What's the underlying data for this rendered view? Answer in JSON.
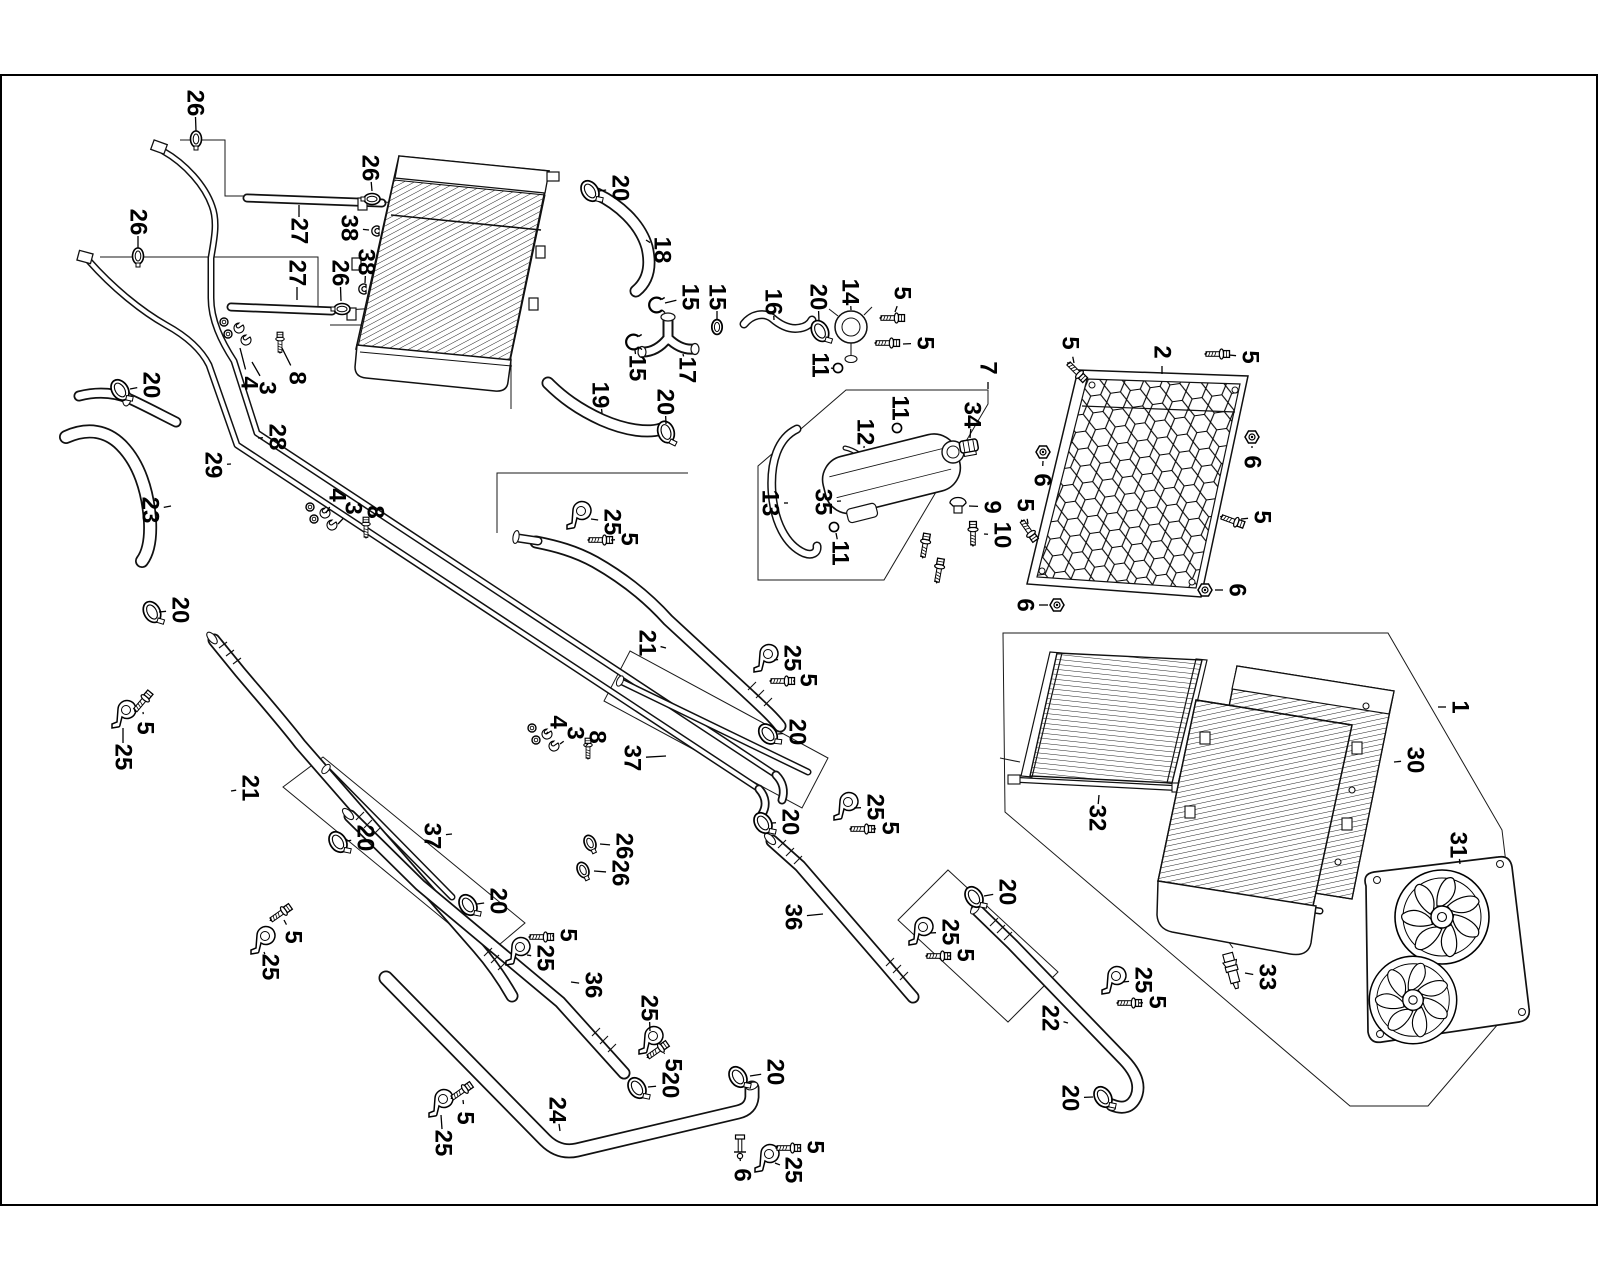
{
  "diagram": {
    "description": "Exploded line-art parts diagram of an engine cooling system (radiators, mesh grille, expansion tank, fan shroud, hoses, pipes and clamps) with numbered callouts",
    "colors": {
      "line": "#111111",
      "background": "#ffffff"
    },
    "part_numbers_shown": [
      1,
      2,
      3,
      4,
      5,
      6,
      7,
      8,
      9,
      10,
      11,
      12,
      13,
      14,
      15,
      16,
      17,
      18,
      19,
      20,
      21,
      22,
      23,
      24,
      25,
      26,
      27,
      28,
      29,
      30,
      31,
      32,
      33,
      34,
      35,
      36,
      37,
      38
    ],
    "callouts": [
      {
        "n": "26",
        "x": 195,
        "y": 103,
        "lx": 196,
        "ly": 131
      },
      {
        "n": "26",
        "x": 370,
        "y": 168,
        "lx": 372,
        "ly": 191
      },
      {
        "n": "27",
        "x": 299,
        "y": 231,
        "lx": 299,
        "ly": 205
      },
      {
        "n": "38",
        "x": 349,
        "y": 228,
        "lx": 369,
        "ly": 230
      },
      {
        "n": "26",
        "x": 138,
        "y": 222,
        "lx": 138,
        "ly": 248
      },
      {
        "n": "38",
        "x": 366,
        "y": 262,
        "lx": 365,
        "ly": 283
      },
      {
        "n": "27",
        "x": 297,
        "y": 273,
        "lx": 297,
        "ly": 300
      },
      {
        "n": "26",
        "x": 340,
        "y": 273,
        "lx": 341,
        "ly": 301
      },
      {
        "n": "20",
        "x": 151,
        "y": 385,
        "lx": 130,
        "ly": 389
      },
      {
        "n": "4",
        "x": 249,
        "y": 383,
        "lx": 240,
        "ly": 348
      },
      {
        "n": "3",
        "x": 267,
        "y": 388,
        "lx": 252,
        "ly": 362
      },
      {
        "n": "8",
        "x": 297,
        "y": 378,
        "lx": 282,
        "ly": 348
      },
      {
        "n": "28",
        "x": 277,
        "y": 437,
        "lx": 258,
        "ly": 438
      },
      {
        "n": "29",
        "x": 213,
        "y": 465,
        "lx": 231,
        "ly": 464
      },
      {
        "n": "23",
        "x": 150,
        "y": 510,
        "lx": 171,
        "ly": 506
      },
      {
        "n": "4",
        "x": 337,
        "y": 495,
        "lx": 326,
        "ly": 513
      },
      {
        "n": "3",
        "x": 353,
        "y": 508,
        "lx": 338,
        "ly": 524
      },
      {
        "n": "8",
        "x": 375,
        "y": 512,
        "lx": 366,
        "ly": 522
      },
      {
        "n": "20",
        "x": 180,
        "y": 610,
        "lx": 159,
        "ly": 612
      },
      {
        "n": "5",
        "x": 145,
        "y": 728,
        "lx": 143,
        "ly": 712
      },
      {
        "n": "25",
        "x": 123,
        "y": 757,
        "lx": 123,
        "ly": 728
      },
      {
        "n": "21",
        "x": 250,
        "y": 788,
        "lx": 231,
        "ly": 791
      },
      {
        "n": "5",
        "x": 293,
        "y": 937,
        "lx": 284,
        "ly": 920
      },
      {
        "n": "25",
        "x": 270,
        "y": 967,
        "lx": 264,
        "ly": 952
      },
      {
        "n": "20",
        "x": 365,
        "y": 838,
        "lx": 347,
        "ly": 841
      },
      {
        "n": "37",
        "x": 432,
        "y": 836,
        "lx": 452,
        "ly": 834
      },
      {
        "n": "20",
        "x": 498,
        "y": 901,
        "lx": 477,
        "ly": 904
      },
      {
        "n": "20",
        "x": 620,
        "y": 188,
        "lx": 599,
        "ly": 191
      },
      {
        "n": "18",
        "x": 662,
        "y": 250,
        "lx": 646,
        "ly": 240
      },
      {
        "n": "15",
        "x": 690,
        "y": 297,
        "lx": 665,
        "ly": 303
      },
      {
        "n": "15",
        "x": 717,
        "y": 297,
        "lx": 717,
        "ly": 319
      },
      {
        "n": "16",
        "x": 773,
        "y": 302,
        "lx": 774,
        "ly": 320
      },
      {
        "n": "20",
        "x": 818,
        "y": 297,
        "lx": 819,
        "ly": 321
      },
      {
        "n": "14",
        "x": 850,
        "y": 292,
        "lx": 851,
        "ly": 310
      },
      {
        "n": "5",
        "x": 902,
        "y": 293,
        "lx": 895,
        "ly": 312
      },
      {
        "n": "5",
        "x": 925,
        "y": 343,
        "lx": 903,
        "ly": 344
      },
      {
        "n": "11",
        "x": 820,
        "y": 365,
        "lx": 831,
        "ly": 368
      },
      {
        "n": "15",
        "x": 637,
        "y": 368,
        "lx": 635,
        "ly": 350
      },
      {
        "n": "17",
        "x": 687,
        "y": 370,
        "lx": 683,
        "ly": 354
      },
      {
        "n": "19",
        "x": 600,
        "y": 395,
        "lx": 602,
        "ly": 413
      },
      {
        "n": "20",
        "x": 665,
        "y": 402,
        "lx": 666,
        "ly": 424
      },
      {
        "n": "7",
        "x": 988,
        "y": 368,
        "lx": 988,
        "ly": 389
      },
      {
        "n": "34",
        "x": 972,
        "y": 415,
        "lx": 970,
        "ly": 438
      },
      {
        "n": "12",
        "x": 865,
        "y": 432,
        "lx": 864,
        "ly": 448
      },
      {
        "n": "11",
        "x": 900,
        "y": 408,
        "lx": 898,
        "ly": 422
      },
      {
        "n": "13",
        "x": 770,
        "y": 503,
        "lx": 788,
        "ly": 503
      },
      {
        "n": "35",
        "x": 823,
        "y": 502,
        "lx": 841,
        "ly": 501
      },
      {
        "n": "11",
        "x": 840,
        "y": 553,
        "lx": 836,
        "ly": 533
      },
      {
        "n": "9",
        "x": 992,
        "y": 507,
        "lx": 969,
        "ly": 506
      },
      {
        "n": "10",
        "x": 1002,
        "y": 535,
        "lx": 984,
        "ly": 534
      },
      {
        "n": "2",
        "x": 1162,
        "y": 352,
        "lx": 1162,
        "ly": 374
      },
      {
        "n": "5",
        "x": 1070,
        "y": 343,
        "lx": 1074,
        "ly": 363
      },
      {
        "n": "5",
        "x": 1250,
        "y": 357,
        "lx": 1229,
        "ly": 355
      },
      {
        "n": "6",
        "x": 1042,
        "y": 480,
        "lx": 1043,
        "ly": 461
      },
      {
        "n": "5",
        "x": 1025,
        "y": 505,
        "lx": 1028,
        "ly": 524
      },
      {
        "n": "6",
        "x": 1252,
        "y": 462,
        "lx": 1252,
        "ly": 446
      },
      {
        "n": "5",
        "x": 1262,
        "y": 517,
        "lx": 1241,
        "ly": 519
      },
      {
        "n": "6",
        "x": 1237,
        "y": 590,
        "lx": 1215,
        "ly": 590
      },
      {
        "n": "6",
        "x": 1025,
        "y": 605,
        "lx": 1048,
        "ly": 605
      },
      {
        "n": "1",
        "x": 1460,
        "y": 707,
        "lx": 1438,
        "ly": 707
      },
      {
        "n": "30",
        "x": 1415,
        "y": 760,
        "lx": 1394,
        "ly": 762
      },
      {
        "n": "32",
        "x": 1097,
        "y": 818,
        "lx": 1099,
        "ly": 795
      },
      {
        "n": "31",
        "x": 1458,
        "y": 845,
        "lx": 1460,
        "ly": 864
      },
      {
        "n": "33",
        "x": 1267,
        "y": 977,
        "lx": 1245,
        "ly": 973
      },
      {
        "n": "25",
        "x": 612,
        "y": 522,
        "lx": 591,
        "ly": 519
      },
      {
        "n": "5",
        "x": 629,
        "y": 539,
        "lx": 611,
        "ly": 540
      },
      {
        "n": "21",
        "x": 647,
        "y": 643,
        "lx": 666,
        "ly": 648
      },
      {
        "n": "25",
        "x": 792,
        "y": 658,
        "lx": 774,
        "ly": 660
      },
      {
        "n": "5",
        "x": 808,
        "y": 680,
        "lx": 793,
        "ly": 681
      },
      {
        "n": "20",
        "x": 797,
        "y": 732,
        "lx": 778,
        "ly": 734
      },
      {
        "n": "37",
        "x": 632,
        "y": 758,
        "lx": 666,
        "ly": 756
      },
      {
        "n": "26",
        "x": 624,
        "y": 846,
        "lx": 600,
        "ly": 844
      },
      {
        "n": "26",
        "x": 620,
        "y": 873,
        "lx": 594,
        "ly": 871
      },
      {
        "n": "4",
        "x": 558,
        "y": 722,
        "lx": 546,
        "ly": 734
      },
      {
        "n": "3",
        "x": 575,
        "y": 733,
        "lx": 560,
        "ly": 744
      },
      {
        "n": "8",
        "x": 597,
        "y": 737,
        "lx": 588,
        "ly": 744
      },
      {
        "n": "36",
        "x": 593,
        "y": 985,
        "lx": 571,
        "ly": 982
      },
      {
        "n": "5",
        "x": 568,
        "y": 935,
        "lx": 552,
        "ly": 936
      },
      {
        "n": "25",
        "x": 545,
        "y": 958,
        "lx": 527,
        "ly": 955
      },
      {
        "n": "25",
        "x": 649,
        "y": 1008,
        "lx": 650,
        "ly": 1031
      },
      {
        "n": "5",
        "x": 673,
        "y": 1065,
        "lx": 664,
        "ly": 1053
      },
      {
        "n": "20",
        "x": 670,
        "y": 1085,
        "lx": 648,
        "ly": 1087
      },
      {
        "n": "24",
        "x": 557,
        "y": 1110,
        "lx": 560,
        "ly": 1131
      },
      {
        "n": "25",
        "x": 443,
        "y": 1143,
        "lx": 441,
        "ly": 1115
      },
      {
        "n": "5",
        "x": 465,
        "y": 1118,
        "lx": 463,
        "ly": 1100
      },
      {
        "n": "20",
        "x": 775,
        "y": 1072,
        "lx": 750,
        "ly": 1076
      },
      {
        "n": "5",
        "x": 815,
        "y": 1147,
        "lx": 798,
        "ly": 1148
      },
      {
        "n": "25",
        "x": 793,
        "y": 1170,
        "lx": 775,
        "ly": 1163
      },
      {
        "n": "6",
        "x": 742,
        "y": 1175,
        "lx": 740,
        "ly": 1158
      },
      {
        "n": "36",
        "x": 793,
        "y": 917,
        "lx": 823,
        "ly": 914
      },
      {
        "n": "25",
        "x": 875,
        "y": 807,
        "lx": 854,
        "ly": 808
      },
      {
        "n": "5",
        "x": 890,
        "y": 828,
        "lx": 872,
        "ly": 829
      },
      {
        "n": "20",
        "x": 1007,
        "y": 892,
        "lx": 984,
        "ly": 896
      },
      {
        "n": "25",
        "x": 950,
        "y": 932,
        "lx": 930,
        "ly": 933
      },
      {
        "n": "5",
        "x": 965,
        "y": 955,
        "lx": 948,
        "ly": 956
      },
      {
        "n": "22",
        "x": 1050,
        "y": 1018,
        "lx": 1068,
        "ly": 1023
      },
      {
        "n": "25",
        "x": 1143,
        "y": 980,
        "lx": 1123,
        "ly": 982
      },
      {
        "n": "5",
        "x": 1157,
        "y": 1002,
        "lx": 1139,
        "ly": 1003
      },
      {
        "n": "20",
        "x": 1070,
        "y": 1098,
        "lx": 1093,
        "ly": 1097
      },
      {
        "n": "20",
        "x": 790,
        "y": 822,
        "lx": 772,
        "ly": 823
      }
    ],
    "glyphs": [
      {
        "t": "clamp20",
        "x": 590,
        "y": 191,
        "r": -15
      },
      {
        "t": "clamp20",
        "x": 120,
        "y": 390,
        "r": -15
      },
      {
        "t": "clamp20",
        "x": 152,
        "y": 612,
        "r": -10
      },
      {
        "t": "clamp20",
        "x": 666,
        "y": 432,
        "r": 0
      },
      {
        "t": "clamp20",
        "x": 820,
        "y": 331,
        "r": -10
      },
      {
        "t": "clamp20",
        "x": 768,
        "y": 734,
        "r": -20
      },
      {
        "t": "clamp20",
        "x": 763,
        "y": 823,
        "r": -15
      },
      {
        "t": "clamp20",
        "x": 468,
        "y": 905,
        "r": -15
      },
      {
        "t": "clamp20",
        "x": 338,
        "y": 842,
        "r": -15
      },
      {
        "t": "clamp20",
        "x": 974,
        "y": 897,
        "r": -15
      },
      {
        "t": "clamp20",
        "x": 738,
        "y": 1077,
        "r": -15
      },
      {
        "t": "clamp20",
        "x": 637,
        "y": 1088,
        "r": -15
      },
      {
        "t": "clamp20",
        "x": 1103,
        "y": 1097,
        "r": -15
      },
      {
        "t": "clamp26",
        "x": 196,
        "y": 139,
        "r": 0
      },
      {
        "t": "clamp26",
        "x": 138,
        "y": 256,
        "r": 0
      },
      {
        "t": "clamp26",
        "x": 372,
        "y": 199,
        "r": 90
      },
      {
        "t": "clamp26",
        "x": 342,
        "y": 309,
        "r": 90
      },
      {
        "t": "clamp26",
        "x": 590,
        "y": 843,
        "r": -25
      },
      {
        "t": "clamp26",
        "x": 583,
        "y": 870,
        "r": -25
      },
      {
        "t": "bracket25",
        "x": 578,
        "y": 516,
        "r": 0
      },
      {
        "t": "bracket25",
        "x": 765,
        "y": 659,
        "r": 0
      },
      {
        "t": "bracket25",
        "x": 123,
        "y": 715,
        "r": 0
      },
      {
        "t": "bracket25",
        "x": 262,
        "y": 941,
        "r": 0
      },
      {
        "t": "bracket25",
        "x": 517,
        "y": 952,
        "r": 0
      },
      {
        "t": "bracket25",
        "x": 650,
        "y": 1041,
        "r": 0
      },
      {
        "t": "bracket25",
        "x": 440,
        "y": 1104,
        "r": 0
      },
      {
        "t": "bracket25",
        "x": 766,
        "y": 1159,
        "r": 0
      },
      {
        "t": "bracket25",
        "x": 845,
        "y": 807,
        "r": 0
      },
      {
        "t": "bracket25",
        "x": 920,
        "y": 932,
        "r": 0
      },
      {
        "t": "bracket25",
        "x": 1113,
        "y": 981,
        "r": 0
      },
      {
        "t": "screwH",
        "x": 601,
        "y": 540,
        "r": 0
      },
      {
        "t": "screwH",
        "x": 783,
        "y": 681,
        "r": 0
      },
      {
        "t": "screwH",
        "x": 143,
        "y": 701,
        "r": -50
      },
      {
        "t": "screwH",
        "x": 281,
        "y": 913,
        "r": -35
      },
      {
        "t": "screwH",
        "x": 542,
        "y": 937,
        "r": 0
      },
      {
        "t": "screwH",
        "x": 658,
        "y": 1050,
        "r": -35
      },
      {
        "t": "screwH",
        "x": 462,
        "y": 1091,
        "r": -35
      },
      {
        "t": "screwH",
        "x": 789,
        "y": 1148,
        "r": 0
      },
      {
        "t": "screwH",
        "x": 863,
        "y": 829,
        "r": 0
      },
      {
        "t": "screwH",
        "x": 939,
        "y": 956,
        "r": 0
      },
      {
        "t": "screwH",
        "x": 1130,
        "y": 1003,
        "r": 0
      },
      {
        "t": "screwH",
        "x": 893,
        "y": 318,
        "r": 0
      },
      {
        "t": "screwH",
        "x": 888,
        "y": 343,
        "r": 0
      },
      {
        "t": "screwH",
        "x": 1218,
        "y": 354,
        "r": 0
      },
      {
        "t": "screwH",
        "x": 1077,
        "y": 372,
        "r": 45
      },
      {
        "t": "screwH",
        "x": 1233,
        "y": 521,
        "r": 20
      },
      {
        "t": "screwH",
        "x": 1029,
        "y": 531,
        "r": 55
      },
      {
        "t": "screwH",
        "x": 973,
        "y": 533,
        "r": -90
      },
      {
        "t": "screwH",
        "x": 925,
        "y": 545,
        "r": -80
      },
      {
        "t": "screwH",
        "x": 939,
        "y": 570,
        "r": -80
      },
      {
        "t": "nut6",
        "x": 1043,
        "y": 452,
        "r": 0
      },
      {
        "t": "nut6",
        "x": 1252,
        "y": 437,
        "r": 0
      },
      {
        "t": "nut6",
        "x": 1205,
        "y": 590,
        "r": 0
      },
      {
        "t": "nut6",
        "x": 1057,
        "y": 605,
        "r": 0
      },
      {
        "t": "oring",
        "x": 838,
        "y": 368,
        "r": 0
      },
      {
        "t": "oring",
        "x": 897,
        "y": 428,
        "r": 0
      },
      {
        "t": "oring",
        "x": 834,
        "y": 527,
        "r": 0
      },
      {
        "t": "ring15",
        "x": 717,
        "y": 327,
        "r": 0
      },
      {
        "t": "cclamp15",
        "x": 657,
        "y": 305,
        "r": 0
      },
      {
        "t": "cclamp15",
        "x": 634,
        "y": 342,
        "r": 0
      },
      {
        "t": "clip38",
        "x": 377,
        "y": 231,
        "r": 0
      },
      {
        "t": "clip38",
        "x": 364,
        "y": 289,
        "r": 0
      },
      {
        "t": "cluster348",
        "x": 240,
        "y": 330,
        "r": 0
      },
      {
        "t": "cluster348",
        "x": 326,
        "y": 515,
        "r": 0
      },
      {
        "t": "cluster348",
        "x": 548,
        "y": 736,
        "r": 0
      },
      {
        "t": "grommet9",
        "x": 958,
        "y": 505,
        "r": 0
      },
      {
        "t": "cap34",
        "x": 969,
        "y": 447,
        "r": -10
      },
      {
        "t": "sensor33",
        "x": 1232,
        "y": 970,
        "r": -15
      },
      {
        "t": "stud6",
        "x": 740,
        "y": 1148,
        "r": 0
      }
    ]
  }
}
